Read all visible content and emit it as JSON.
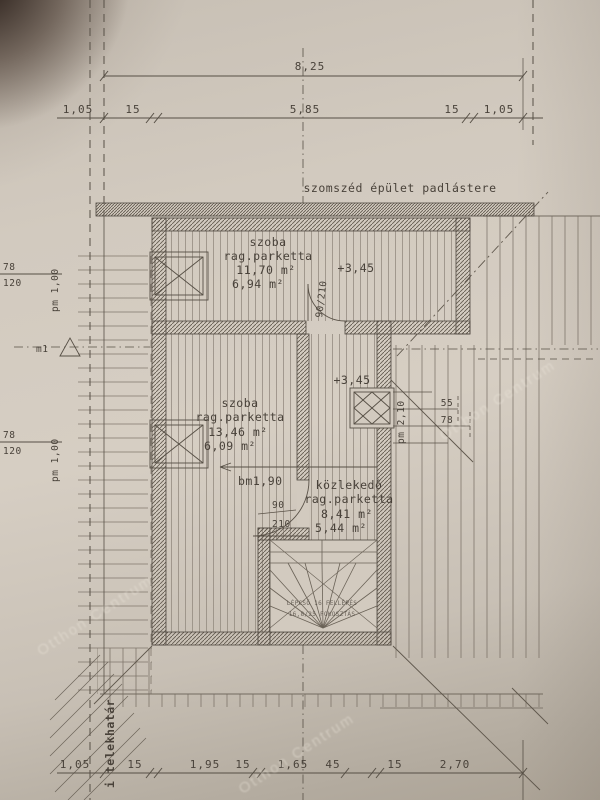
{
  "colors": {
    "paper": "#d2cabf",
    "ink": "#49423a",
    "wall_hatch": "#5f574c"
  },
  "neighbor": {
    "label": "szomszéd épület padlástere"
  },
  "dims": {
    "top": {
      "total": "8,25",
      "segments": [
        "1,05",
        "15",
        "5,85",
        "15",
        "1,05"
      ]
    },
    "bottom": {
      "segments": [
        "1,05",
        "15",
        "1,95",
        "15",
        "1,65",
        "45",
        "15",
        "2,70"
      ]
    }
  },
  "rooms": {
    "top": {
      "name": "szoba",
      "floor": "rag.parketta",
      "gross": "11,70 m²",
      "net": "6,94 m²",
      "level": "+3,45"
    },
    "mid": {
      "name": "szoba",
      "floor": "rag.parketta",
      "gross": "13,46 m²",
      "net": "6,09 m²"
    },
    "corridor": {
      "name": "közlekedő",
      "floor": "rag.parketta",
      "gross": "8,41 m²",
      "net": "5,44 m²",
      "level": "+3,45"
    }
  },
  "doors": {
    "top_size": "90/210",
    "mid_width": "90",
    "mid_height": "210",
    "headroom": "bm1,90",
    "right_label": "pm 2,10"
  },
  "windows": {
    "left": {
      "width": "78",
      "height": "120",
      "sill": "pm 1,00"
    },
    "roof": {
      "a": "55",
      "b": "78"
    }
  },
  "markers": {
    "section": "m1",
    "boundary": "i telekhatár"
  },
  "stairs": {
    "note1": "LÉPCSŐ 16 FELLÉPÉS",
    "note2": "16,8/25 FOKOSZTÁS"
  },
  "watermark": {
    "label": "Otthon Centrum"
  }
}
